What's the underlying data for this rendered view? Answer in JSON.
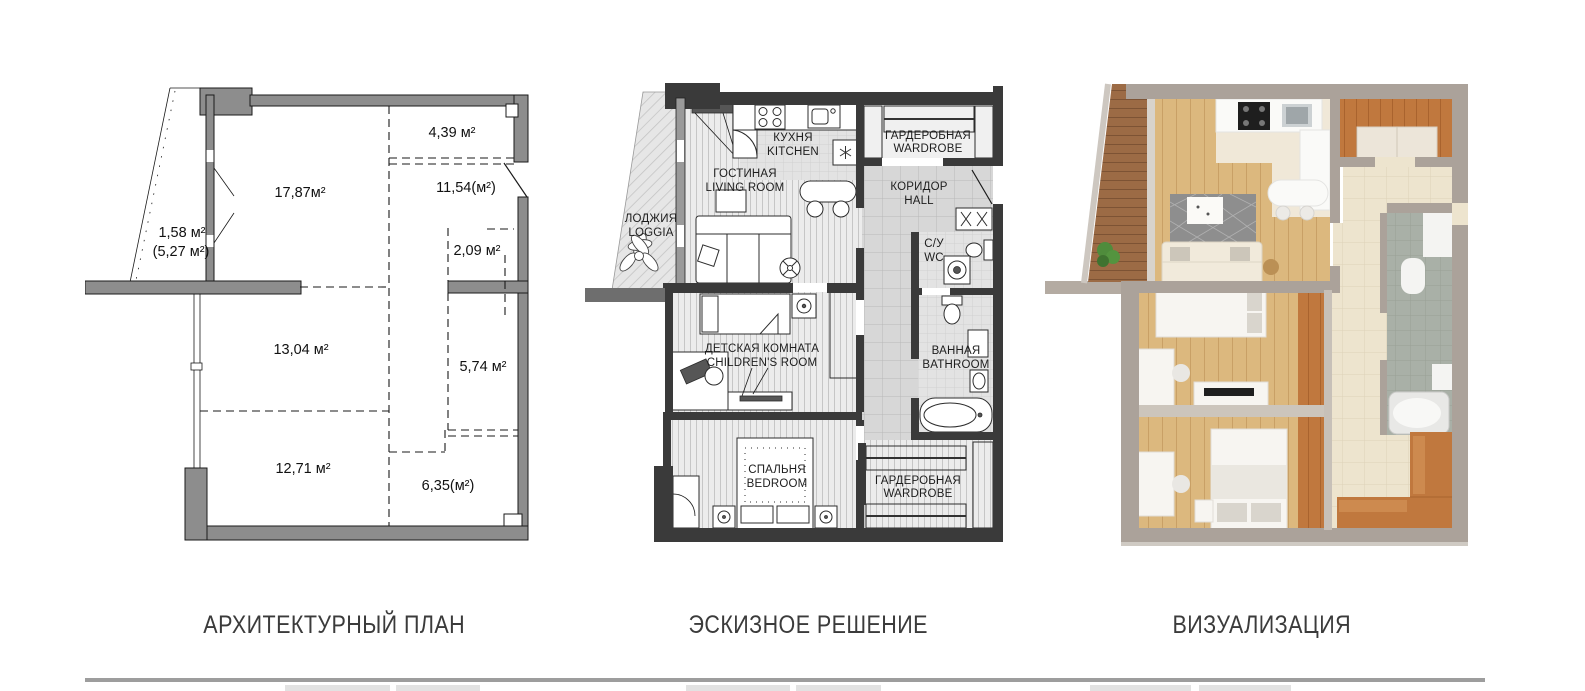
{
  "plan1": {
    "caption": "АРХИТЕКТУРНЫЙ ПЛАН",
    "areas": [
      {
        "room": "living-room",
        "label": "17,87м²"
      },
      {
        "room": "kitchen-niche",
        "label": "4,39 м²"
      },
      {
        "room": "kitchen-zone-total",
        "label": "11,54(м²)"
      },
      {
        "room": "loggia",
        "label": "1,58 м²"
      },
      {
        "room": "loggia-full",
        "label": "(5,27 м²)"
      },
      {
        "room": "small-room",
        "label": "2,09 м²"
      },
      {
        "room": "room-13",
        "label": "13,04 м²"
      },
      {
        "room": "bathroom-zone",
        "label": "5,74 м²"
      },
      {
        "room": "room-12",
        "label": "12,71 м²"
      },
      {
        "room": "hall-zone",
        "label": "6,35(м²)"
      }
    ]
  },
  "plan2": {
    "caption": "ЭСКИЗНОЕ РЕШЕНИЕ",
    "rooms": [
      {
        "id": "loggia",
        "ru": "ЛОДЖИЯ",
        "en": "LOGGIA"
      },
      {
        "id": "kitchen",
        "ru": "КУХНЯ",
        "en": "KITCHEN"
      },
      {
        "id": "living-room",
        "ru": "ГОСТИНАЯ",
        "en": "LIVING ROOM"
      },
      {
        "id": "wardrobe-entry",
        "ru": "ГАРДЕРОБНАЯ",
        "en": "WARDROBE"
      },
      {
        "id": "hall",
        "ru": "КОРИДОР",
        "en": "HALL"
      },
      {
        "id": "wc",
        "ru": "С/У",
        "en": "WC"
      },
      {
        "id": "childrens-room",
        "ru": "ДЕТСКАЯ КОМНАТА",
        "en": "CHILDREN'S ROOM"
      },
      {
        "id": "bathroom",
        "ru": "ВАННАЯ",
        "en": "BATHROOM"
      },
      {
        "id": "bedroom",
        "ru": "СПАЛЬНЯ",
        "en": "BEDROOM"
      },
      {
        "id": "wardrobe-bedroom",
        "ru": "ГАРДЕРОБНАЯ",
        "en": "WARDROBE"
      }
    ]
  },
  "plan3": {
    "caption": "ВИЗУАЛИЗАЦИЯ"
  },
  "palette": {
    "wall_gray": "#8d8d8d",
    "wall_dark": "#3a3a3a",
    "wall_taupe": "#aba29a",
    "wood_floor": "#dcb87e",
    "wood_orange": "#c0783e",
    "tile_cream": "#ede4ce",
    "bath_tile": "#a9b0a7",
    "balcony_wood": "#9c6b45"
  }
}
